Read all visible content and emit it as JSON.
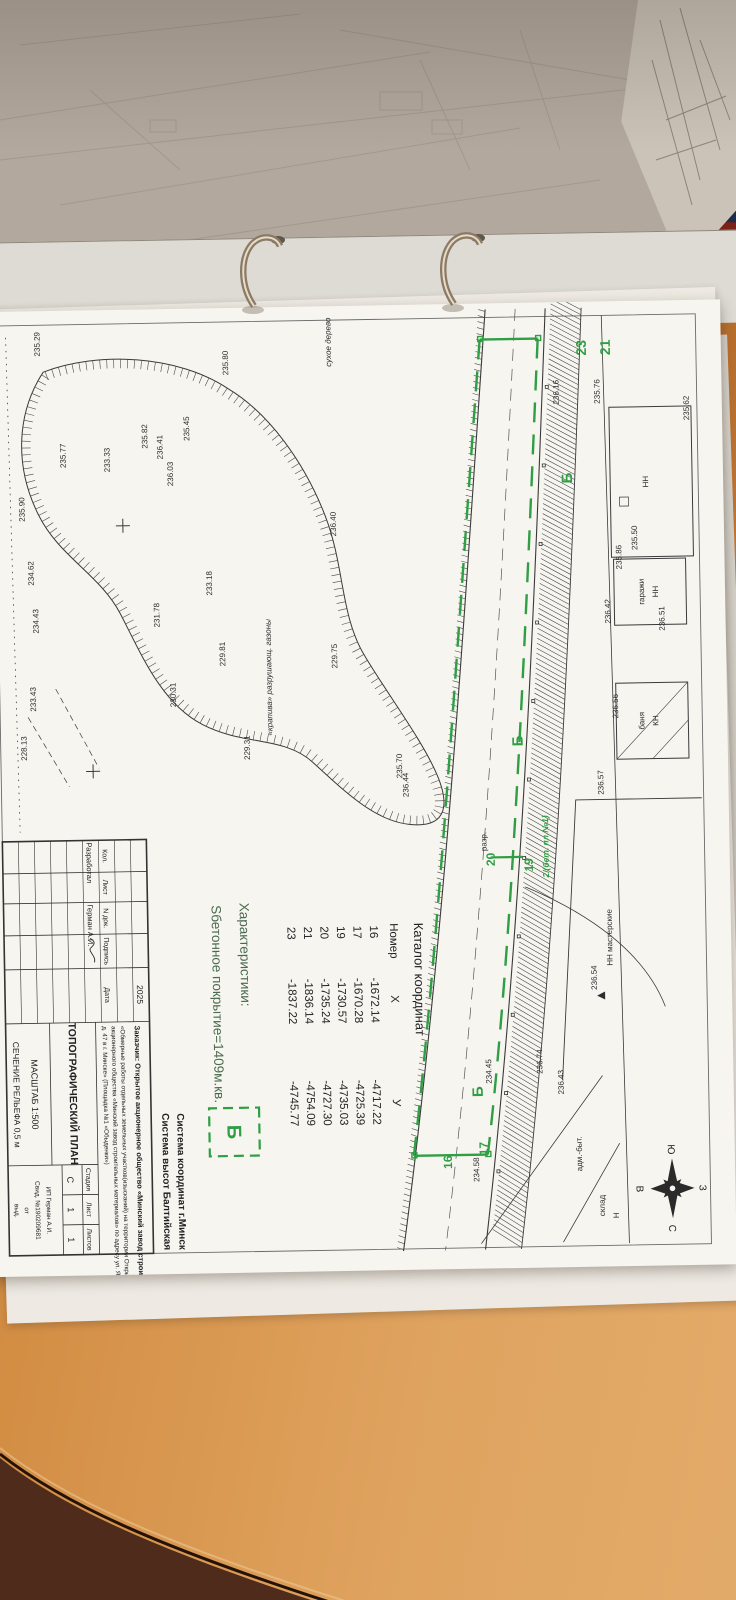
{
  "colors": {
    "green": "#2f9e44",
    "ink": "#2d2d2d",
    "char_green": "#4a6b4f",
    "paper": "#f7f5f0",
    "navy_folder": "#1f2b47",
    "red_folder": "#7c2317",
    "desk_wood": "#d28c42",
    "floor": "#4e2b1b"
  },
  "catalog": {
    "title": "Каталог координат",
    "col_n": "Номер",
    "col_x": "X",
    "col_y": "У",
    "rows": [
      [
        "16",
        "-1672.14",
        "-4717.22"
      ],
      [
        "17",
        "-1670.28",
        "-4725.39"
      ],
      [
        "19",
        "-1730.57",
        "-4735.03"
      ],
      [
        "20",
        "-1735.24",
        "-4727.30"
      ],
      [
        "21",
        "-1836.14",
        "-4754.09"
      ],
      [
        "23",
        "-1837.22",
        "-4745.77"
      ]
    ]
  },
  "characteristics": {
    "title": "Характеристики:",
    "area": "Sбетонное покрытие=1409м.кв.",
    "legend": "Б"
  },
  "coord_system": {
    "line1": "Система координат г.Минск",
    "line2": "Система высот Балтийская"
  },
  "compass": {
    "n": "С",
    "s": "Ю",
    "w": "З",
    "e": "В"
  },
  "stamp": {
    "year": "2025",
    "customer_line": "Заказчик: Открытое акционерное общество «Минский завод строительных материалов»",
    "project_line1": "«Обмерные работы отдельных земельных участков(изысканий) на территории Открытого",
    "project_line2": "акционерного общества «Минский завод строительных материалов» по адресу ул. Я. Мавра,",
    "project_line3": "д. 47 в г. Минске» (Площадка №1 «Обыденки»)",
    "col_headers": [
      "Кол.",
      "Лист",
      "N док.",
      "Подпись",
      "Дата"
    ],
    "role": "Разработал",
    "name": "Герман А.И.",
    "title": "ТОПОГРАФИЧЕСКИЙ ПЛАН",
    "scale": "МАСШТАБ 1:500",
    "relief": "СЕЧЕНИЕ РЕЛЬЕФА 0,5 м",
    "stage_header": "Стадия",
    "sheet_header": "Лист",
    "sheets_header": "Листов",
    "stage": "С",
    "sheet": "1",
    "sheets": "1",
    "firm1": "ИП Герман А.И.",
    "firm2": "Свид. №190209681",
    "firm3": "от",
    "firm4": "выд."
  },
  "map": {
    "green_labels": [
      {
        "t": "21",
        "u": 40,
        "v": 88,
        "s": 14
      },
      {
        "t": "23",
        "u": 40,
        "v": 112,
        "s": 14
      },
      {
        "t": "19",
        "u": 556,
        "v": 174,
        "s": 12
      },
      {
        "t": "20",
        "u": 550,
        "v": 212,
        "s": 12
      },
      {
        "t": "17",
        "u": 839,
        "v": 224,
        "s": 12
      },
      {
        "t": "16",
        "u": 852,
        "v": 260,
        "s": 12
      },
      {
        "t": "Б",
        "u": 170,
        "v": 128,
        "s": 15
      },
      {
        "t": "Б",
        "u": 432,
        "v": 182,
        "s": 15
      },
      {
        "t": "Б",
        "u": 782,
        "v": 228,
        "s": 15
      },
      {
        "t": "2/(бет. пл.№1)",
        "u": 538,
        "v": 158,
        "s": 8.5,
        "i": 1
      }
    ],
    "labels": [
      {
        "t": "НН",
        "u": 175,
        "v": 52
      },
      {
        "t": "НН",
        "u": 285,
        "v": 44
      },
      {
        "t": "гаражи",
        "u": 285,
        "v": 58
      },
      {
        "t": "КН",
        "u": 414,
        "v": 46
      },
      {
        "t": "баня",
        "u": 414,
        "v": 60
      },
      {
        "t": "НН мастерские",
        "u": 630,
        "v": 96
      },
      {
        "t": "236.54",
        "u": 670,
        "v": 112
      },
      {
        "t": "адм.-быт.",
        "u": 846,
        "v": 130
      },
      {
        "t": "Н",
        "u": 908,
        "v": 94
      },
      {
        "t": "склад",
        "u": 898,
        "v": 108
      },
      {
        "t": "разр.",
        "u": 532,
        "v": 220
      },
      {
        "t": "«крапива» разрушающ. газоны",
        "u": 364,
        "v": 432,
        "i": 1
      },
      {
        "t": "сухое дерево",
        "u": 30,
        "v": 367,
        "i": 1
      }
    ],
    "elevations": [
      {
        "t": "235.29",
        "u": 27,
        "v": 658
      },
      {
        "t": "235.80",
        "u": 49,
        "v": 470
      },
      {
        "t": "236.41",
        "u": 132,
        "v": 537
      },
      {
        "t": "235.45",
        "u": 114,
        "v": 510
      },
      {
        "t": "235.82",
        "u": 121,
        "v": 552
      },
      {
        "t": "233.33",
        "u": 144,
        "v": 590
      },
      {
        "t": "235.77",
        "u": 139,
        "v": 634
      },
      {
        "t": "236.03",
        "u": 159,
        "v": 527
      },
      {
        "t": "235.90",
        "u": 192,
        "v": 676
      },
      {
        "t": "233.18",
        "u": 269,
        "v": 490
      },
      {
        "t": "234.62",
        "u": 256,
        "v": 668
      },
      {
        "t": "234.43",
        "u": 304,
        "v": 664
      },
      {
        "t": "233.43",
        "u": 382,
        "v": 668
      },
      {
        "t": "228.13",
        "u": 431,
        "v": 678
      },
      {
        "t": "231.78",
        "u": 300,
        "v": 543
      },
      {
        "t": "229.81",
        "u": 340,
        "v": 478
      },
      {
        "t": "229.75",
        "u": 344,
        "v": 366
      },
      {
        "t": "230.31",
        "u": 380,
        "v": 528
      },
      {
        "t": "229.31",
        "u": 434,
        "v": 455
      },
      {
        "t": "236.40",
        "u": 212,
        "v": 365
      },
      {
        "t": "235.70",
        "u": 455,
        "v": 303
      },
      {
        "t": "236.44",
        "u": 474,
        "v": 297
      },
      {
        "t": "236.16",
        "u": 84,
        "v": 140
      },
      {
        "t": "235.76",
        "u": 84,
        "v": 99
      },
      {
        "t": "235.62",
        "u": 102,
        "v": 10
      },
      {
        "t": "235.50",
        "u": 231,
        "v": 64
      },
      {
        "t": "235.86",
        "u": 250,
        "v": 80
      },
      {
        "t": "236.51",
        "u": 312,
        "v": 38
      },
      {
        "t": "236.42",
        "u": 304,
        "v": 92
      },
      {
        "t": "236.56",
        "u": 399,
        "v": 86
      },
      {
        "t": "236.57",
        "u": 475,
        "v": 102
      },
      {
        "t": "236.74",
        "u": 753,
        "v": 168
      },
      {
        "t": "236.43",
        "u": 774,
        "v": 147
      },
      {
        "t": "234.45",
        "u": 762,
        "v": 219
      },
      {
        "t": "234.58",
        "u": 860,
        "v": 233
      }
    ]
  }
}
